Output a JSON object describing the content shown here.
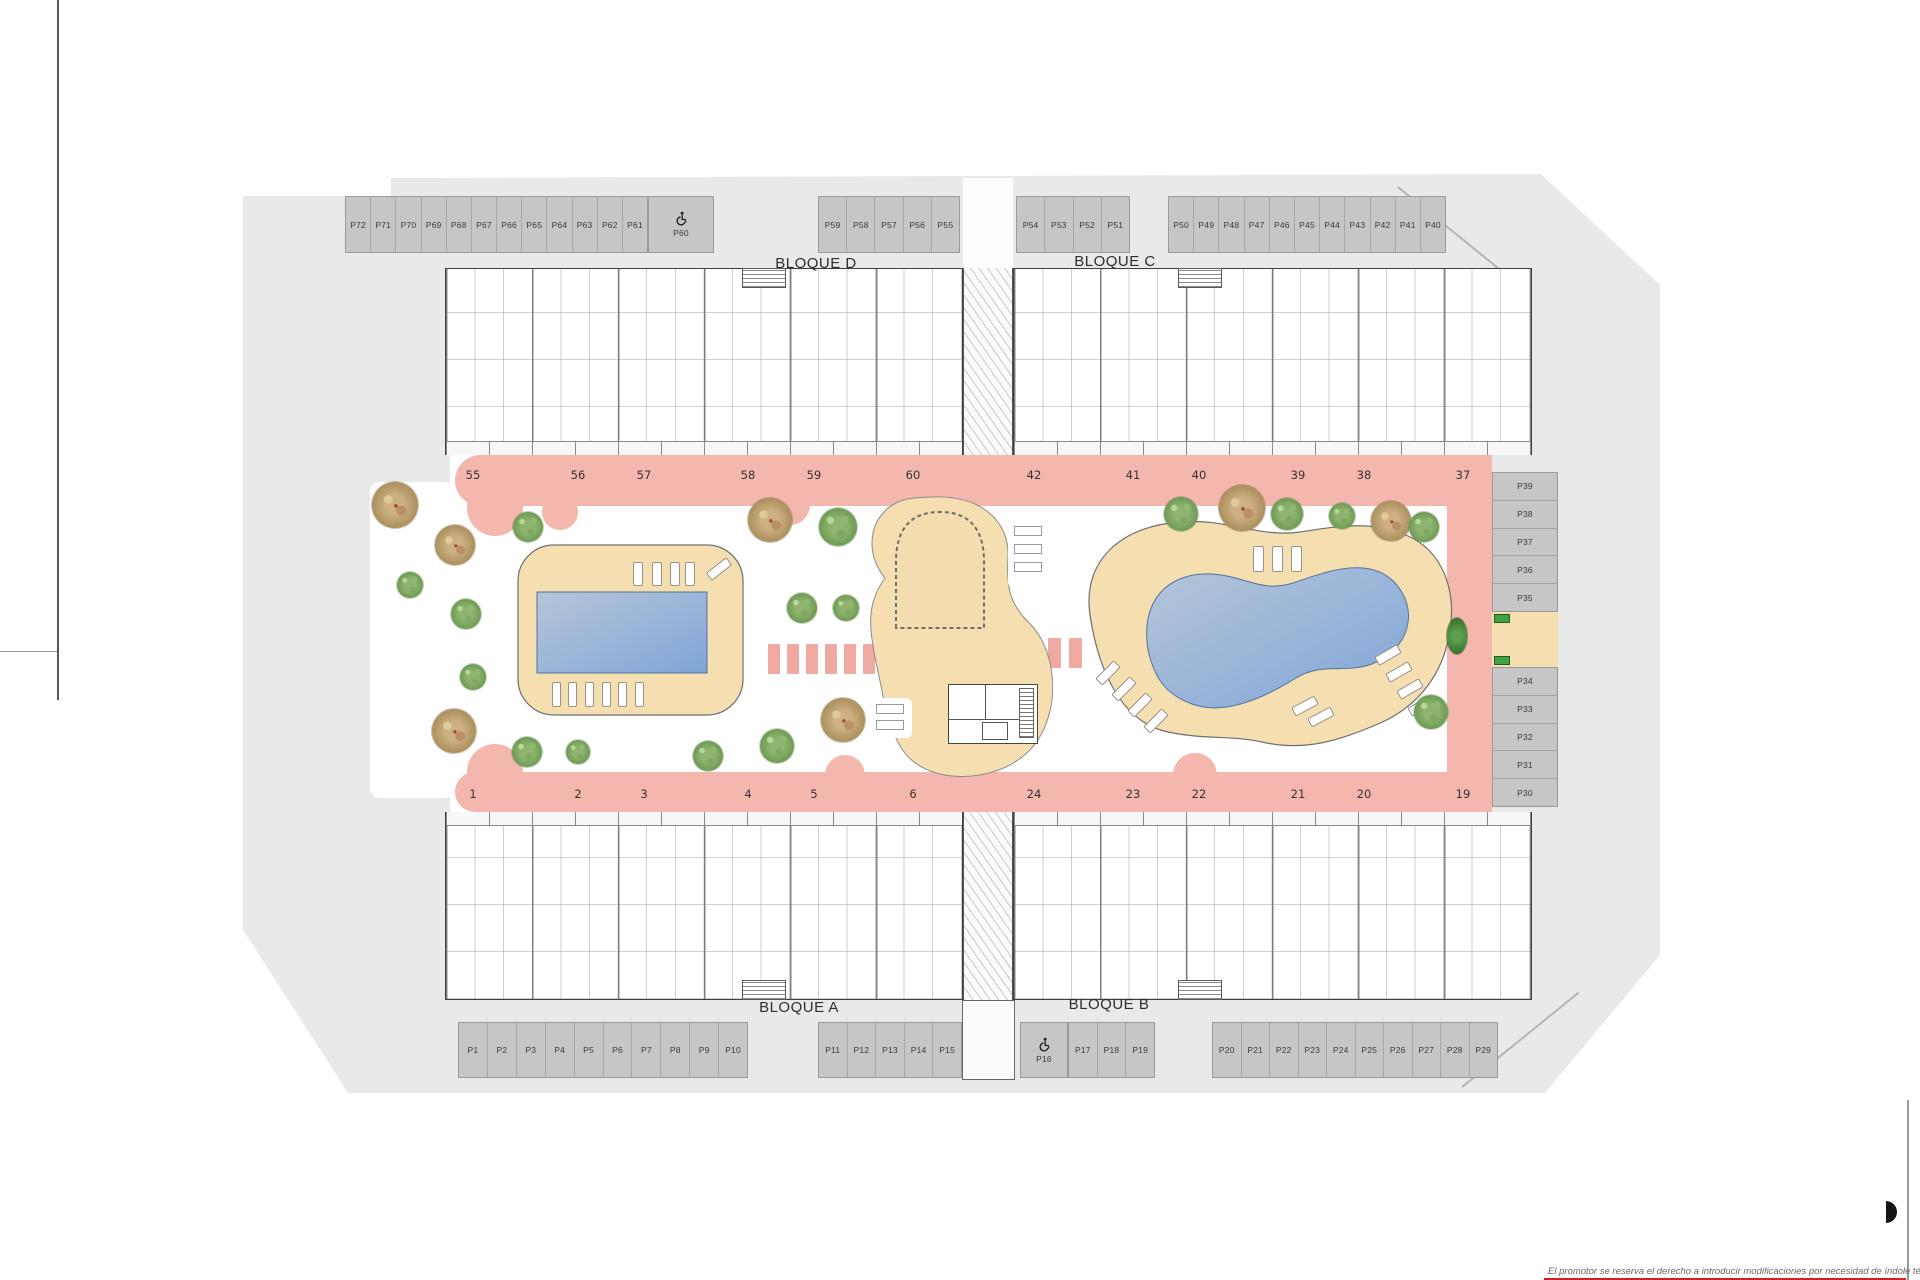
{
  "blocks": {
    "top_left": "BLOQUE D",
    "top_right": "BLOQUE C",
    "bottom_left": "BLOQUE A",
    "bottom_right": "BLOQUE B"
  },
  "parking": {
    "top_left": [
      "P72",
      "P71",
      "P70",
      "P69",
      "P68",
      "P67",
      "P66",
      "P65",
      "P64",
      "P63",
      "P62",
      "P61"
    ],
    "top_left_accessible": "P60",
    "top_center": [
      "P59",
      "P58",
      "P57",
      "P56",
      "P55"
    ],
    "top_center_right": [
      "P54",
      "P53",
      "P52",
      "P51"
    ],
    "top_right": [
      "P50",
      "P49",
      "P48",
      "P47",
      "P46",
      "P45",
      "P44",
      "P43",
      "P42",
      "P41",
      "P40"
    ],
    "right_upper": [
      "P39",
      "P38",
      "P37",
      "P36",
      "P35"
    ],
    "right_lower": [
      "P34",
      "P33",
      "P32",
      "P31",
      "P30"
    ],
    "bottom_left": [
      "P1",
      "P2",
      "P3",
      "P4",
      "P5",
      "P6",
      "P7",
      "P8",
      "P9",
      "P10"
    ],
    "bottom_center_left": [
      "P11",
      "P12",
      "P13",
      "P14",
      "P15"
    ],
    "bottom_accessible": "P16",
    "bottom_center_right": [
      "P17",
      "P18",
      "P19"
    ],
    "bottom_right": [
      "P20",
      "P21",
      "P22",
      "P23",
      "P24",
      "P25",
      "P26",
      "P27",
      "P28",
      "P29"
    ]
  },
  "terraces": {
    "top": [
      "55",
      "56",
      "57",
      "58",
      "59",
      "60",
      "42",
      "41",
      "40",
      "39",
      "38",
      "37"
    ],
    "bottom": [
      "1",
      "2",
      "3",
      "4",
      "5",
      "6",
      "24",
      "23",
      "22",
      "21",
      "20",
      "19"
    ]
  },
  "icons": {
    "accessible": "wheelchair"
  },
  "disclaimer": "El promotor se reserva el derecho a introducir modificaciones por necesidad de índole técnica o legal",
  "colors": {
    "site_gray": "#e9e9e9",
    "parking_slot": "#c6c6c6",
    "walkway_pink": "#f4b7ad",
    "deck_beige": "#f5dfb1",
    "pool_blue": "#7fa6d8",
    "tree_green": "#6d9a52",
    "tree_olive": "#ab8f5d",
    "accent_red": "#cc2222"
  }
}
